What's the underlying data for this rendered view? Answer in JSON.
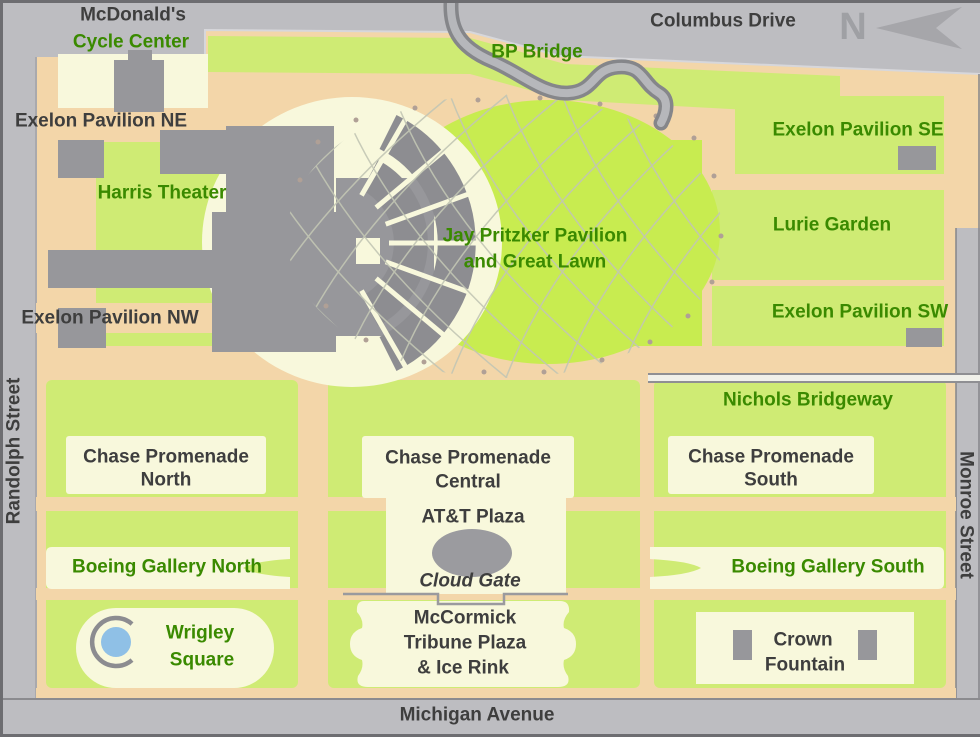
{
  "map_title": "Millennium Park map",
  "labels": {
    "mcdonalds": "McDonald's",
    "cycle_center": "Cycle Center",
    "bp_bridge": "BP Bridge",
    "columbus_drive": "Columbus Drive",
    "compass_n": "N",
    "exelon_ne": "Exelon Pavilion NE",
    "exelon_se": "Exelon Pavilion SE",
    "harris_theater": "Harris Theater",
    "pritzker_line1": "Jay Pritzker Pavilion",
    "pritzker_line2": "and Great Lawn",
    "lurie_garden": "Lurie Garden",
    "exelon_nw": "Exelon Pavilion NW",
    "exelon_sw": "Exelon Pavilion SW",
    "randolph_street": "Randolph Street",
    "monroe_street": "Monroe Street",
    "nichols_bridgeway": "Nichols Bridgeway",
    "chase_north_line1": "Chase Promenade",
    "chase_north_line2": "North",
    "chase_central_line1": "Chase Promenade",
    "chase_central_line2": "Central",
    "chase_south_line1": "Chase Promenade",
    "chase_south_line2": "South",
    "att_plaza": "AT&T Plaza",
    "cloud_gate": "Cloud Gate",
    "boeing_north": "Boeing Gallery North",
    "boeing_south": "Boeing Gallery South",
    "wrigley_line1": "Wrigley",
    "wrigley_line2": "Square",
    "mccormick_line1": "McCormick",
    "mccormick_line2": "Tribune Plaza",
    "mccormick_line3": "& Ice Rink",
    "crown_line1": "Crown",
    "crown_line2": "Fountain",
    "michigan_avenue": "Michigan Avenue"
  },
  "colors": {
    "street_gray": "#bdbdc1",
    "street_edge_dark": "#6d6d71",
    "path_peach": "#f3d6a9",
    "park_green": "#cfeb74",
    "lawn_green": "#c8ec50",
    "plaza_cream": "#f8f8dc",
    "building_gray": "#97979b",
    "seating_gray": "#8d8d91",
    "bridge_gray": "#85868a",
    "water_blue": "#8fc0e6",
    "label_green": "#3a8a00",
    "label_dark": "#3e3e3e",
    "compass_gray": "#9fa0a4"
  }
}
